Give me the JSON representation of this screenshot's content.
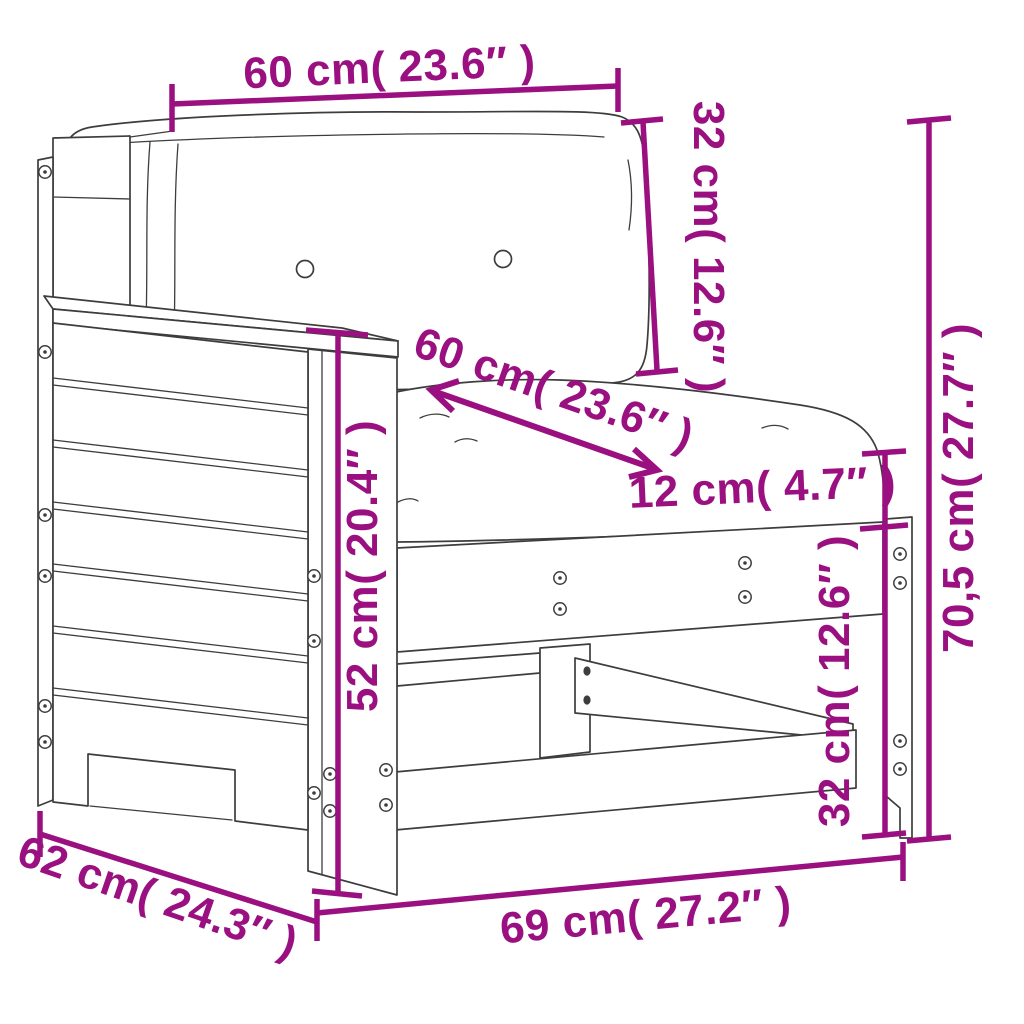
{
  "colors": {
    "line": "#3d3d3d",
    "dimension": "#9a1080",
    "background": "#ffffff"
  },
  "dims": {
    "top_width": {
      "label": "60 cm( 23.6″ )",
      "cm": 60,
      "inch": 23.6
    },
    "back_cushion_height": {
      "label": "32 cm( 12.6″ )",
      "cm": 32,
      "inch": 12.6
    },
    "seat_width": {
      "label": "60 cm( 23.6″ )",
      "cm": 60,
      "inch": 23.6
    },
    "seat_thickness": {
      "label": "12 cm( 4.7″ )",
      "cm": 12,
      "inch": 4.7
    },
    "overall_height": {
      "label": "70,5 cm( 27.7″ )",
      "cm": 70.5,
      "inch": 27.7
    },
    "armrest_height": {
      "label": "52 cm( 20.4″ )",
      "cm": 52,
      "inch": 20.4
    },
    "frame_height": {
      "label": "32 cm( 12.6″ )",
      "cm": 32,
      "inch": 12.6
    },
    "depth": {
      "label": "62 cm( 24.3″ )",
      "cm": 62,
      "inch": 24.3
    },
    "width": {
      "label": "69 cm( 27.2″ )",
      "cm": 69,
      "inch": 27.2
    }
  }
}
